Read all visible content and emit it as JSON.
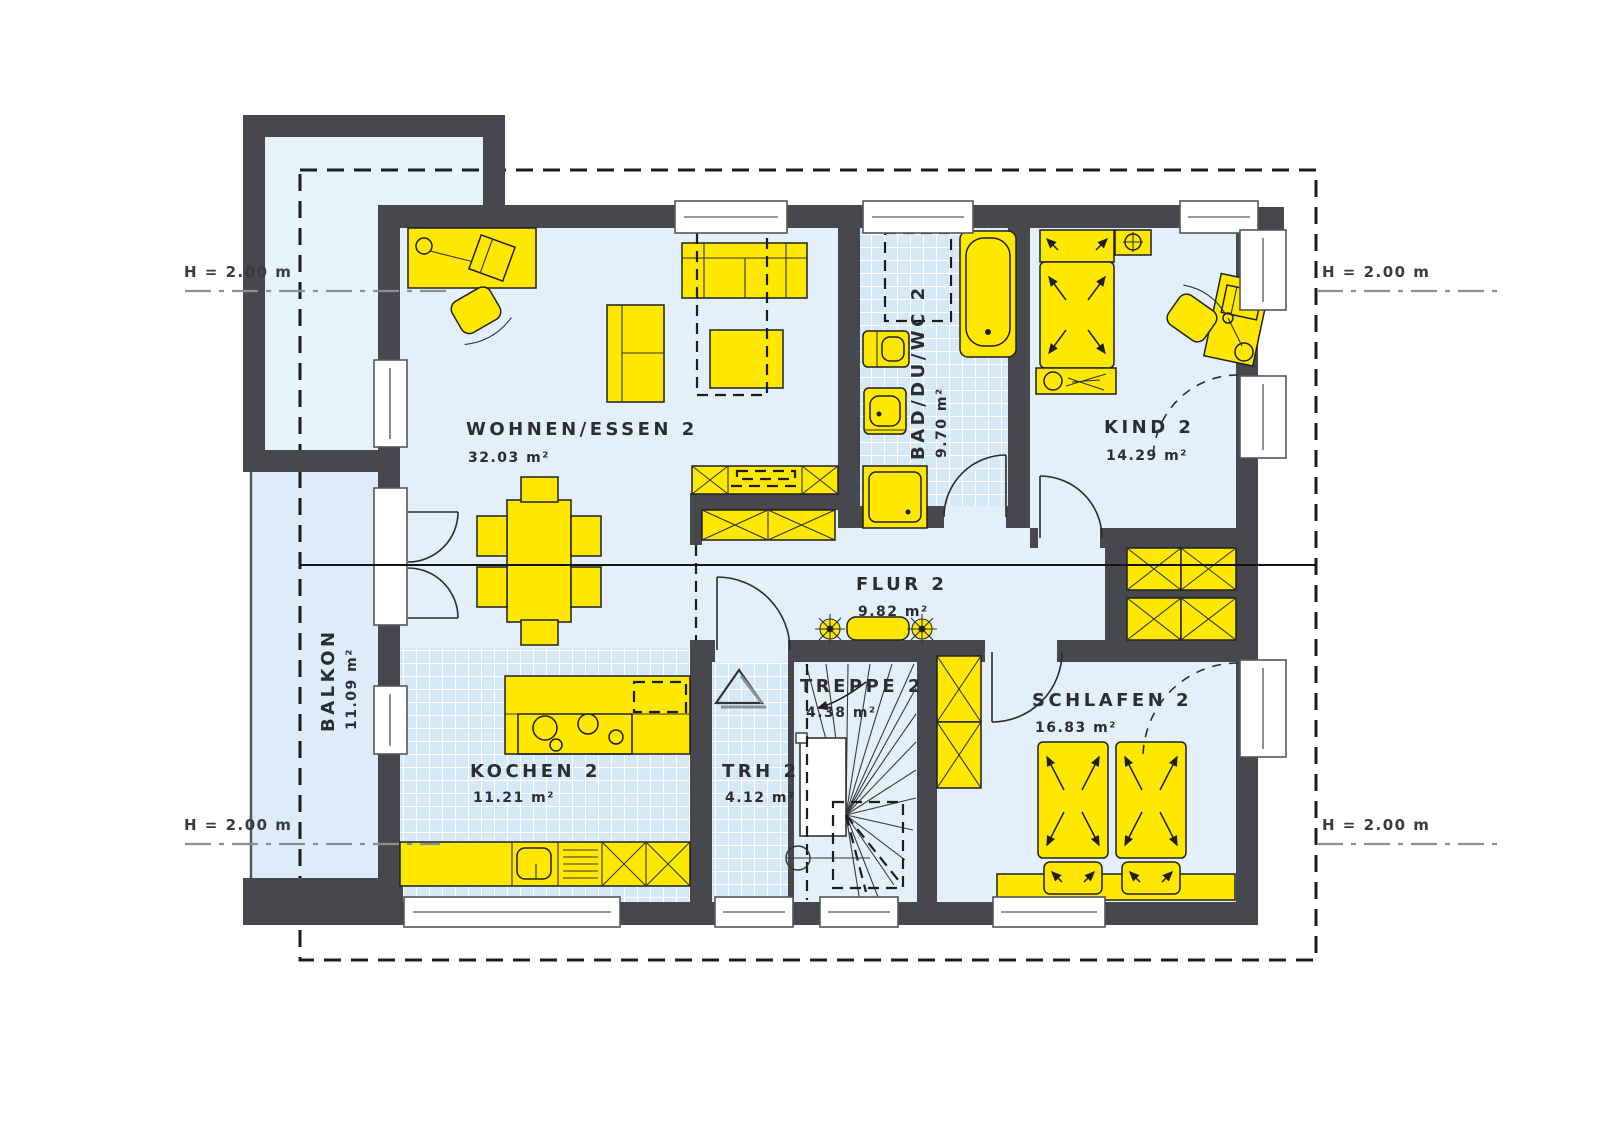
{
  "plan": {
    "type": "floorplan-upper-storey",
    "rooms": {
      "wohnen": {
        "label": "WOHNEN/ESSEN 2",
        "area": "32.03 m²"
      },
      "bad": {
        "label": "BAD/DU/WC 2",
        "area": "9.70 m²"
      },
      "kind": {
        "label": "KIND 2",
        "area": "14.29 m²"
      },
      "flur": {
        "label": "FLUR 2",
        "area": "9.82 m²"
      },
      "schlafen": {
        "label": "SCHLAFEN 2",
        "area": "16.83 m²"
      },
      "kochen": {
        "label": "KOCHEN 2",
        "area": "11.21 m²"
      },
      "trh": {
        "label": "TRH 2",
        "area": "4.12 m²"
      },
      "treppe": {
        "label": "TREPPE 2",
        "area": "4.38 m²"
      },
      "balkon": {
        "label": "BALKON",
        "area": "11.09 m²"
      }
    },
    "markers": {
      "left_top": "H = 2.00 m",
      "left_bottom": "H = 2.00 m",
      "right_top": "H = 2.00 m",
      "right_bottom": "H = 2.00 m"
    },
    "colors": {
      "wall": "#47484e",
      "furniture": "#ffe800",
      "floor": "#e3f0fa",
      "tile_floor": "#d7e9f7",
      "line": "#1c1c1c"
    }
  }
}
